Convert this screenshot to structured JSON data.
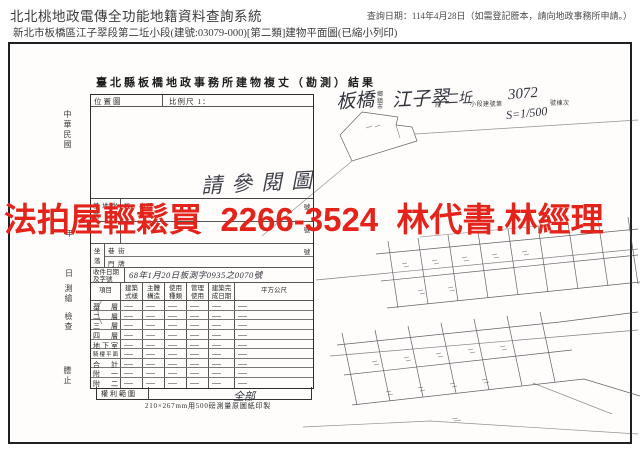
{
  "header": {
    "system_title": "北北桃地政電傳全功能地籍資料查詢系統",
    "query_date": "查詢日期：114年4月28日（如需登記謄本，請向地政事務所申請。）",
    "subtitle": "新北市板橋區江子翠段第二坵小段(建號:03079-000)[第二類]建物平面圖(已縮小列印)"
  },
  "overlay": {
    "ad_text": "法拍屋輕鬆買  2266-3524  林代書.林經理",
    "color": "#e4231b"
  },
  "document": {
    "title": "臺北縣板橋地政事務所建物複丈（勘測）結果",
    "margin_era": "中華民國",
    "margin_year": "年",
    "margin_day": "日",
    "margin_survey": "測繪",
    "margin_check": "檢查",
    "margin_stamp": "謄止",
    "location_map_label": "位置圖",
    "scale_label": "比例尺 1：",
    "handwritten_note": "請參閱圖",
    "suffix_no": "號",
    "site_row": {
      "label": "基地坐落",
      "sub": "段　小段"
    },
    "address_row": {
      "label": "坐落",
      "sub1": "巷 街",
      "sub2": "門 牌"
    },
    "receipt_row": {
      "label": "收件日期及字號",
      "value": "68年1月20日板測字0935之0070號"
    },
    "table": {
      "headers": [
        "項目",
        "建築式樣",
        "主體構造",
        "使用種類",
        "管理使用",
        "建築完成日期",
        "平方公尺"
      ],
      "rows": [
        "基層",
        "二層",
        "三層",
        "四層",
        "地下室",
        "騎樓平面",
        "合計",
        "附一",
        "附二"
      ]
    },
    "rights_label": "權利範圍",
    "rights_value": "全部",
    "paper_note": "210×267mm用500磅測量原圖紙印製"
  },
  "sketch": {
    "township": "板橋",
    "township_label": "鄉鎮市",
    "section": "江子翠",
    "section_label": "段",
    "subsection": "二坵",
    "subsection_label": "小段建號第",
    "building_number": "3072",
    "building_number_label": "號棟次",
    "scale_note": "S=1/500"
  }
}
